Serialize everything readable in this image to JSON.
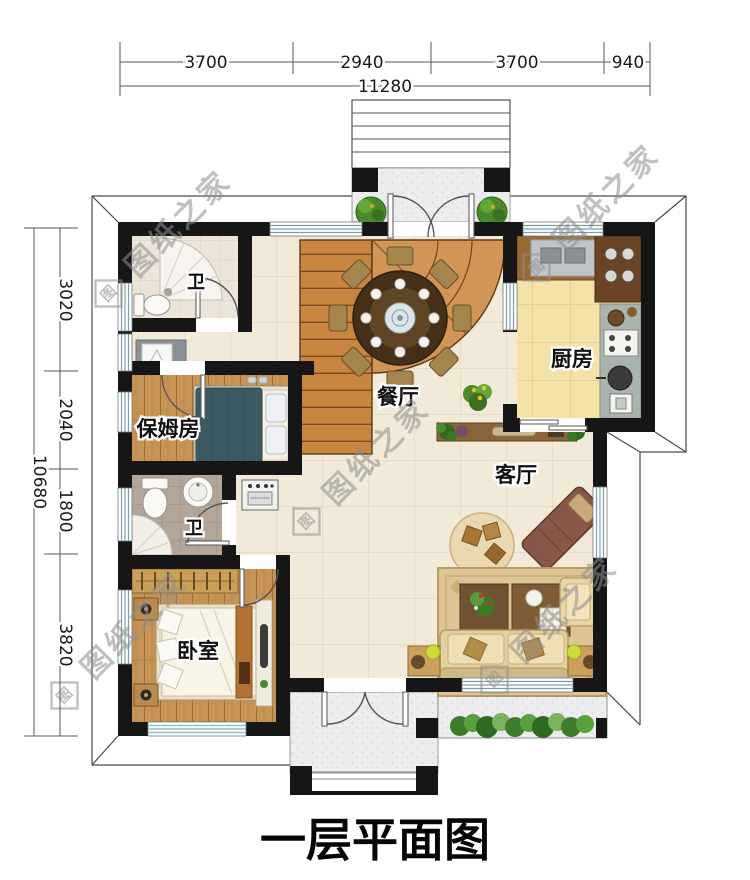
{
  "title": "一层平面图",
  "watermark": {
    "text": "图纸之家",
    "logo": "图"
  },
  "dimensions": {
    "top": {
      "segments": [
        "3700",
        "2940",
        "3700",
        "940"
      ],
      "total": "11280"
    },
    "left": {
      "segments": [
        "3020",
        "2040",
        "1800",
        "3820"
      ],
      "total": "10680"
    }
  },
  "rooms": {
    "dining": {
      "label": "餐厅"
    },
    "kitchen": {
      "label": "厨房"
    },
    "living": {
      "label": "客厅"
    },
    "nanny": {
      "label": "保姆房"
    },
    "bedroom": {
      "label": "卧室"
    },
    "bath_upper": {
      "label": "卫"
    },
    "bath_lower": {
      "label": "卫"
    }
  },
  "colors": {
    "wall": "#161616",
    "stair_wood": "#c8853f",
    "floor_cream": "#f2ead8",
    "floor_kitchen": "#f5e2a9",
    "floor_wood": "#c69354",
    "window_glass": "#7d9ea6",
    "hedge_green": "#59a23b"
  }
}
